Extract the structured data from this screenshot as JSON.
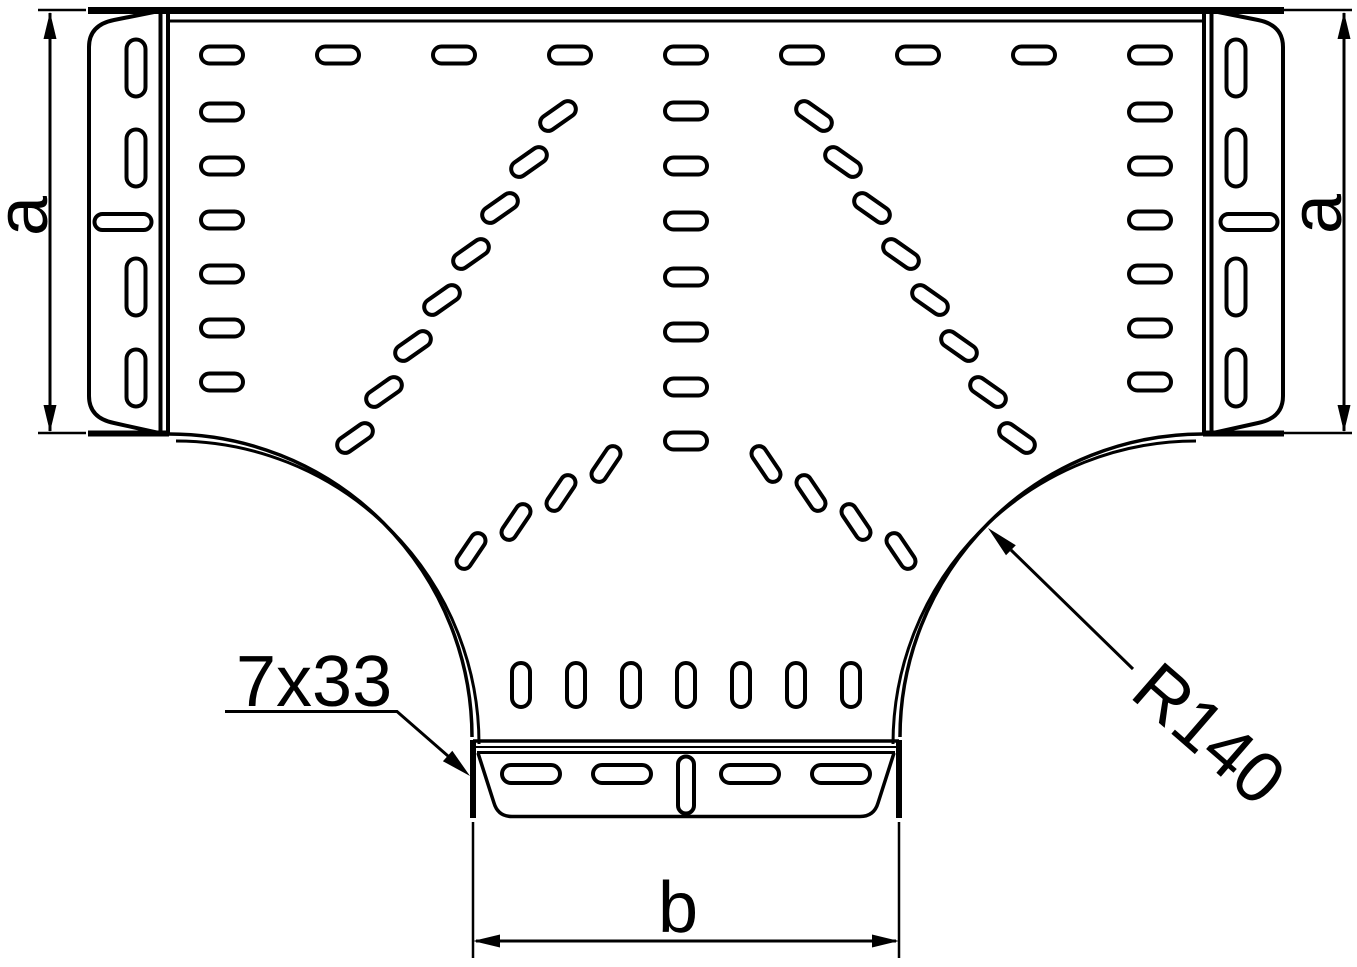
{
  "labels": {
    "dim_a_left": "a",
    "dim_a_right": "a",
    "dim_b": "b",
    "slot_size_callout": "7x33",
    "radius_callout": "R140"
  },
  "colors": {
    "line": "#000000",
    "background": "#ffffff"
  },
  "perforations": [
    {
      "name": "top-row",
      "w": 42,
      "h": 17,
      "rot": 0,
      "centers": [
        [
          222,
          55
        ],
        [
          338,
          55
        ],
        [
          454,
          55
        ],
        [
          570,
          55
        ],
        [
          686,
          55
        ],
        [
          802,
          55
        ],
        [
          918,
          55
        ],
        [
          1034,
          55
        ],
        [
          1150,
          55
        ]
      ]
    },
    {
      "name": "left-column",
      "w": 42,
      "h": 17,
      "rot": 0,
      "centers": [
        [
          222,
          112
        ],
        [
          222,
          166
        ],
        [
          222,
          220
        ],
        [
          222,
          274
        ],
        [
          222,
          328
        ],
        [
          222,
          382
        ]
      ]
    },
    {
      "name": "right-column",
      "w": 42,
      "h": 17,
      "rot": 0,
      "centers": [
        [
          1150,
          112
        ],
        [
          1150,
          166
        ],
        [
          1150,
          220
        ],
        [
          1150,
          274
        ],
        [
          1150,
          328
        ],
        [
          1150,
          382
        ]
      ]
    },
    {
      "name": "center-column",
      "w": 42,
      "h": 17,
      "rot": 0,
      "centers": [
        [
          686,
          111
        ],
        [
          686,
          166
        ],
        [
          686,
          221
        ],
        [
          686,
          277
        ],
        [
          686,
          332
        ],
        [
          686,
          387
        ],
        [
          686,
          441
        ]
      ]
    },
    {
      "name": "fan-upper-left",
      "w": 40,
      "h": 16,
      "rot": -35,
      "centers": [
        [
          558,
          116
        ],
        [
          529,
          162
        ],
        [
          500,
          208
        ],
        [
          471,
          254
        ],
        [
          442,
          300
        ],
        [
          413,
          346
        ],
        [
          384,
          392
        ],
        [
          355,
          438
        ]
      ]
    },
    {
      "name": "fan-upper-right",
      "w": 40,
      "h": 16,
      "rot": 35,
      "centers": [
        [
          814,
          116
        ],
        [
          843,
          162
        ],
        [
          872,
          208
        ],
        [
          901,
          254
        ],
        [
          930,
          300
        ],
        [
          959,
          346
        ],
        [
          988,
          392
        ],
        [
          1017,
          438
        ]
      ]
    },
    {
      "name": "fan-lower-left",
      "w": 40,
      "h": 15,
      "rot": -56,
      "centers": [
        [
          606,
          464
        ],
        [
          561,
          493
        ],
        [
          516,
          522
        ],
        [
          471,
          551
        ]
      ]
    },
    {
      "name": "fan-lower-right",
      "w": 40,
      "h": 15,
      "rot": 56,
      "centers": [
        [
          766,
          464
        ],
        [
          811,
          493
        ],
        [
          856,
          522
        ],
        [
          901,
          551
        ]
      ]
    },
    {
      "name": "branch-bottom-row",
      "w": 18,
      "h": 44,
      "rot": 0,
      "centers": [
        [
          521,
          685
        ],
        [
          576,
          685
        ],
        [
          631,
          685
        ],
        [
          686,
          685
        ],
        [
          741,
          685
        ],
        [
          796,
          685
        ],
        [
          851,
          685
        ]
      ]
    },
    {
      "name": "left-plate-vertical",
      "w": 19,
      "h": 57,
      "rot": 0,
      "centers": [
        [
          136,
          68
        ],
        [
          136,
          158
        ],
        [
          136,
          287
        ],
        [
          136,
          378
        ]
      ]
    },
    {
      "name": "left-plate-horizontal",
      "w": 57,
      "h": 16,
      "rot": 0,
      "centers": [
        [
          123,
          222
        ]
      ]
    },
    {
      "name": "right-plate-vertical",
      "w": 19,
      "h": 57,
      "rot": 0,
      "centers": [
        [
          1236,
          68
        ],
        [
          1236,
          158
        ],
        [
          1236,
          287
        ],
        [
          1236,
          378
        ]
      ]
    },
    {
      "name": "right-plate-horizontal",
      "w": 57,
      "h": 16,
      "rot": 0,
      "centers": [
        [
          1249,
          222
        ]
      ]
    },
    {
      "name": "bottom-flange-horizontal",
      "w": 58,
      "h": 18,
      "rot": 0,
      "centers": [
        [
          531,
          774
        ],
        [
          622,
          774
        ],
        [
          750,
          774
        ],
        [
          841,
          774
        ]
      ]
    },
    {
      "name": "bottom-flange-vertical",
      "w": 16,
      "h": 57,
      "rot": 0,
      "centers": [
        [
          686,
          785
        ]
      ]
    }
  ]
}
